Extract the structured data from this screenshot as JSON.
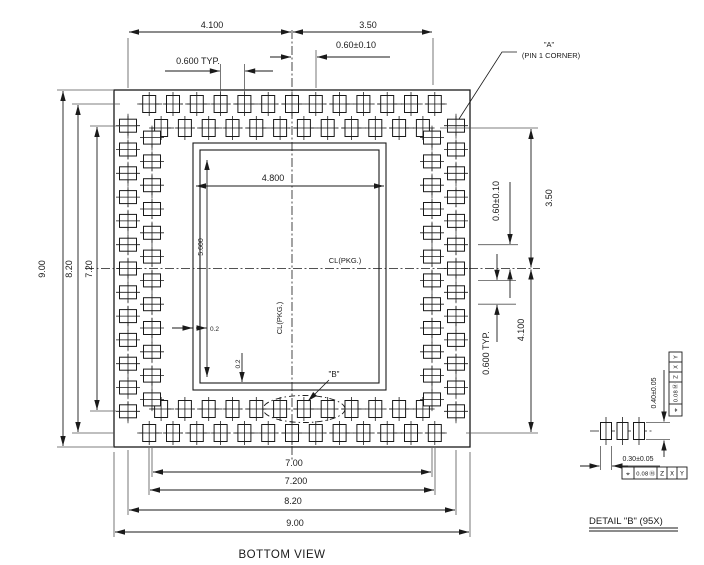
{
  "title": "BOTTOM VIEW",
  "package": {
    "dimensions": {
      "top": [
        "4.100",
        "3.50",
        "0.60±0.10",
        "0.600 TYP."
      ],
      "left": [
        "9.00",
        "8.20",
        "7.20"
      ],
      "right": [
        "0.60±0.10",
        "3.50",
        "0.600 TYP.",
        "4.100"
      ],
      "bottom": [
        "7.00",
        "7.200",
        "8.20",
        "9.00"
      ],
      "inner": {
        "width": "4.800",
        "height": "5.600",
        "offset_x": "0.2",
        "offset_y": "0.2"
      },
      "centerline_h": "CL(PKG.)",
      "centerline_v": "CL(PKG.)"
    },
    "callouts": {
      "pin1_line1": "\"A\"",
      "pin1_line2": "(PIN 1 CORNER)",
      "detail_b": "\"B\""
    }
  },
  "detail_b": {
    "label": "DETAIL \"B\" (95X)",
    "pad_length": "0.40±0.05",
    "pad_width": "0.30±0.05",
    "fcf_vertical": {
      "symbol": "⌖",
      "tolerance": "0.08",
      "modifier": "Ⓜ",
      "datum1": "Z",
      "datum2": "X",
      "datum3": "Y"
    },
    "fcf_horizontal": {
      "symbol": "⌖",
      "tolerance": "0.08",
      "modifier": "Ⓜ",
      "datum1": "Z",
      "datum2": "X",
      "datum3": "Y"
    }
  },
  "colors": {
    "line": "#1a1a1a",
    "background": "#ffffff"
  }
}
